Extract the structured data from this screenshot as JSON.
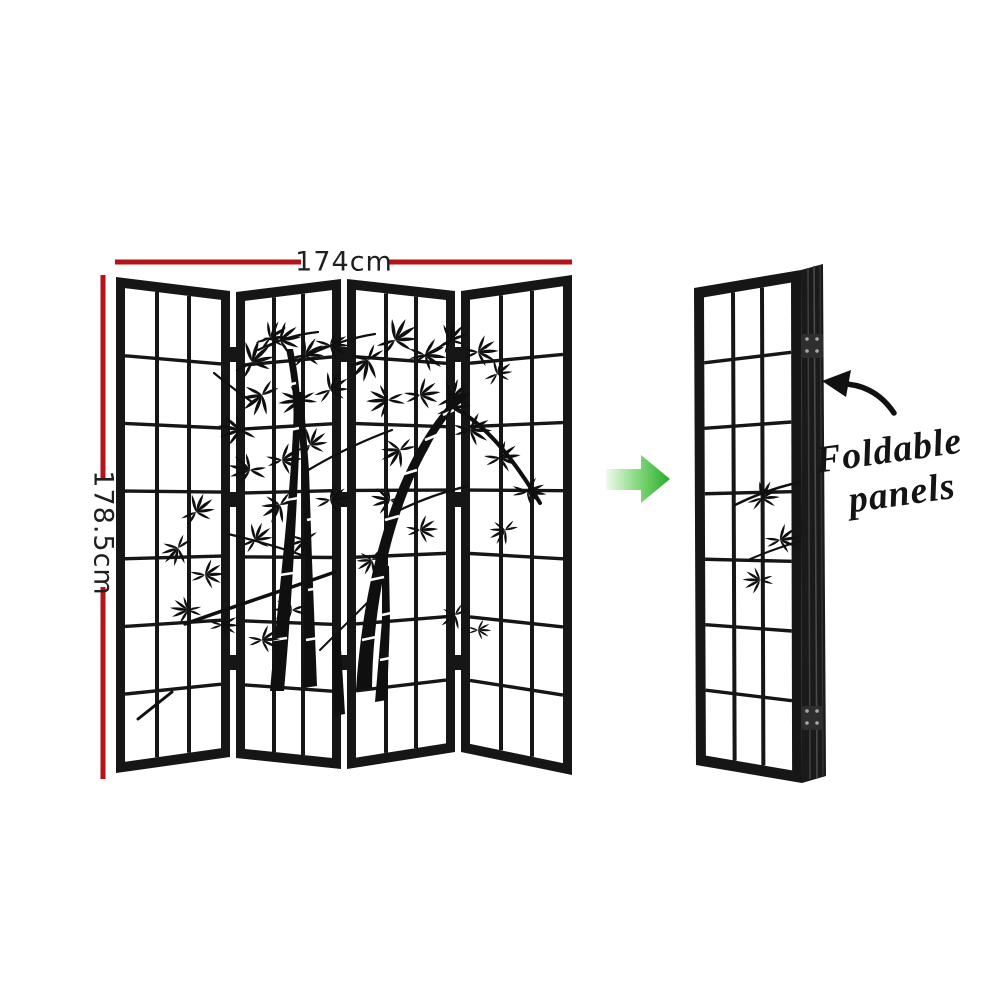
{
  "annotations": {
    "width_label": "174cm",
    "height_label": "178.5cm"
  },
  "note": {
    "line1": "Foldable",
    "line2": "panels"
  },
  "screen": {
    "unfolded_panel_count": 4,
    "folded_panel_count": 1,
    "grid_columns": 3,
    "grid_rows": 7
  },
  "colors": {
    "dimension_line": "#b5121a",
    "arrow_green_start": "#f0faef",
    "arrow_green_mid": "#8edc86",
    "arrow_green_end": "#27ac27",
    "frame_black": "#161616",
    "panel_white": "#ffffff",
    "annotation_black": "#141414"
  },
  "icons": {
    "right_arrow": "right-arrow-icon",
    "curved_arrow": "curved-arrow-icon"
  }
}
